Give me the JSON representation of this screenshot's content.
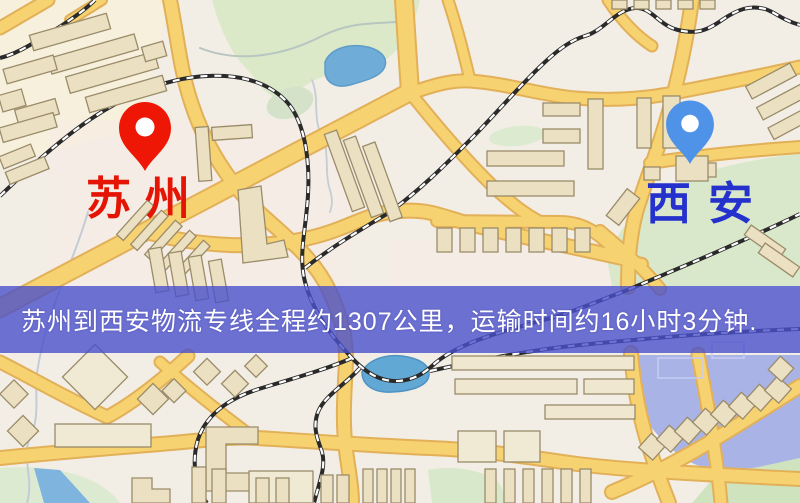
{
  "banner": {
    "text": "苏州到西安物流专线全程约1307公里，运输时间约16小时3分钟.",
    "background_color": "#4a50cc",
    "text_color": "#ffffff"
  },
  "route": {
    "origin": "苏州",
    "destination": "西安",
    "distance_text": "约1307公里",
    "duration_text": "约16小时3分钟"
  },
  "markers": {
    "origin": {
      "label": "苏州",
      "pin_color": "#ee1605",
      "label_color": "#e51505"
    },
    "destination": {
      "label": "西安",
      "pin_color": "#4f93e8",
      "label_color": "#2531cc"
    }
  },
  "map": {
    "style": "street-map",
    "background_color": "#f3eee5",
    "road_color": "#f6d271",
    "road_casing_color": "#e2af52",
    "railway_color": "#2a2a2a",
    "park_color": "#d9e8c9",
    "water_color": "#6fadd8",
    "water_lavender_color": "#aab3e6",
    "building_color": "#ece0c2"
  }
}
